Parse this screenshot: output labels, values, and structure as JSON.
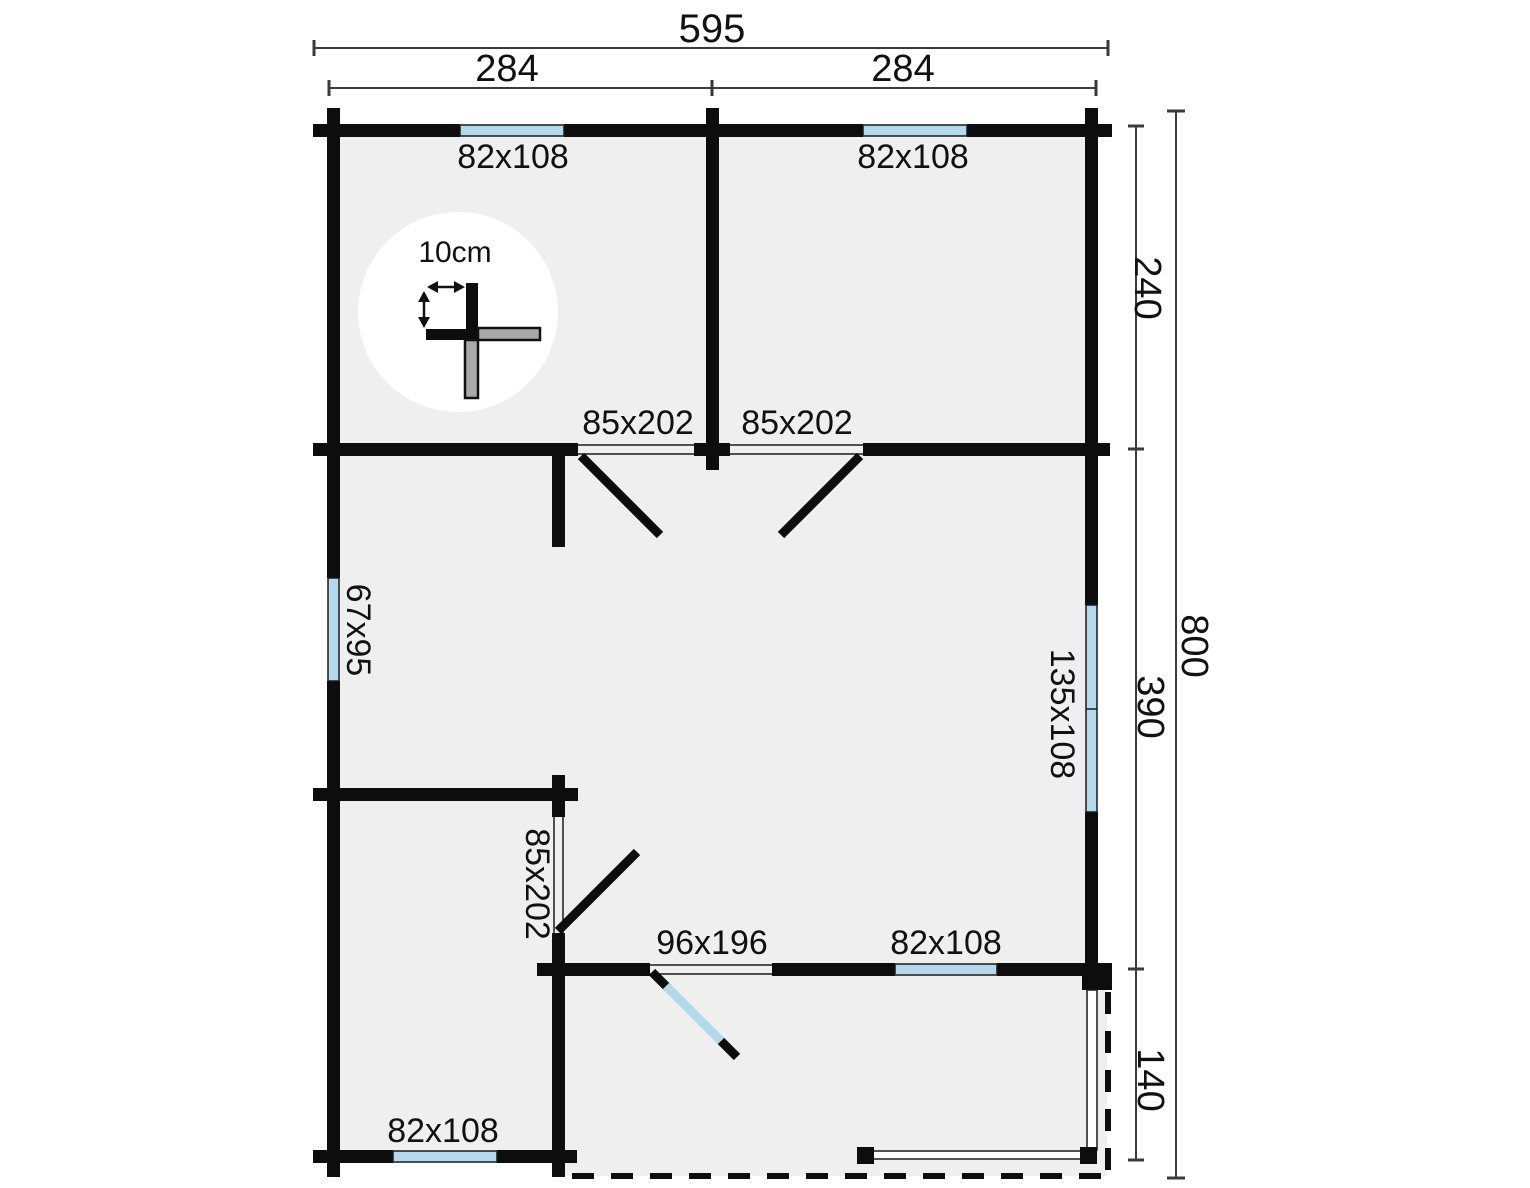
{
  "plan": {
    "overall": {
      "width": "595",
      "height": "800"
    },
    "spans": {
      "top_left": "284",
      "top_right": "284",
      "right_top": "240",
      "right_middle": "390",
      "right_bottom": "140"
    },
    "openings": {
      "window_top_left": "82x108",
      "window_top_right": "82x108",
      "door_interior_left": "85x202",
      "door_interior_right": "85x202",
      "window_side_left": "67x95",
      "window_side_right": "135x108",
      "door_interior_bottom": "85x202",
      "door_entry": "96x196",
      "window_bottom_right": "82x108",
      "window_bottom_left": "82x108"
    },
    "scale_detail": {
      "label": "10cm"
    },
    "colors": {
      "wall": "#0d0d0d",
      "window": "#b5d9ec",
      "floor": "#efefef",
      "gray": "#a9a9a9",
      "dim": "#3a3a3a"
    }
  }
}
